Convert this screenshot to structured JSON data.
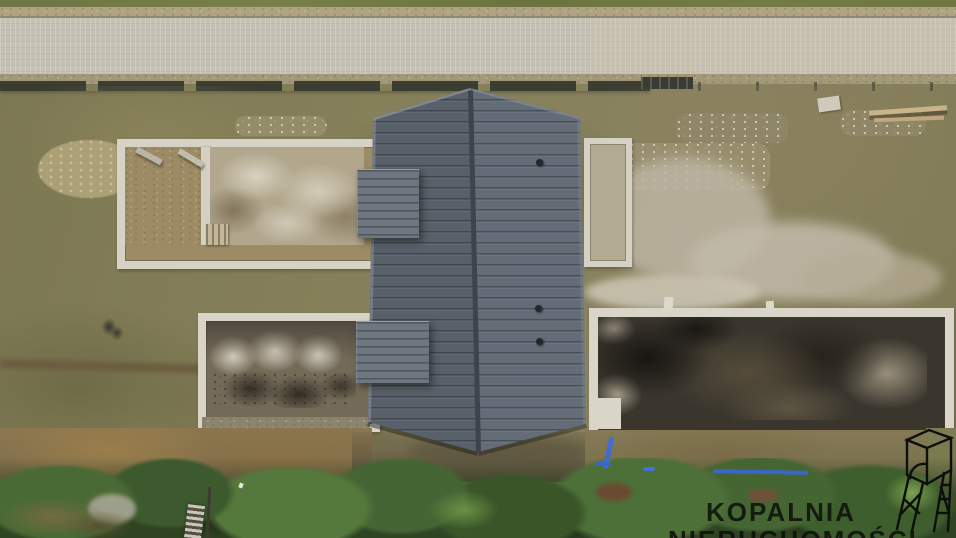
{
  "scene": {
    "type": "aerial-drone-photo",
    "subject": "Top-down drone view of a house under construction: dark gray gabled roof, white strip foundations of two side wings with concrete slabs, paved access road with fence at top, hedge row at bottom",
    "watermark": {
      "line1": "KOPALNIA",
      "line2": "NIERUCHOMOŚCI",
      "logo": "mine-headframe"
    },
    "palette": {
      "roof_left_facet": "#58606a",
      "roof_right_facet": "#646d77",
      "road": "#c6c1b5",
      "grass_base": "#827d58",
      "hedge_green": "#3e5c2e",
      "foundation_frame": "#d8d4c8",
      "upper_slab": "#b2a78d",
      "lower_left_slab": "#746a58",
      "lower_right_slab": "#3a362e",
      "pipe_blue": "#3a6bd6",
      "watermark_text": "#0e110b"
    }
  }
}
